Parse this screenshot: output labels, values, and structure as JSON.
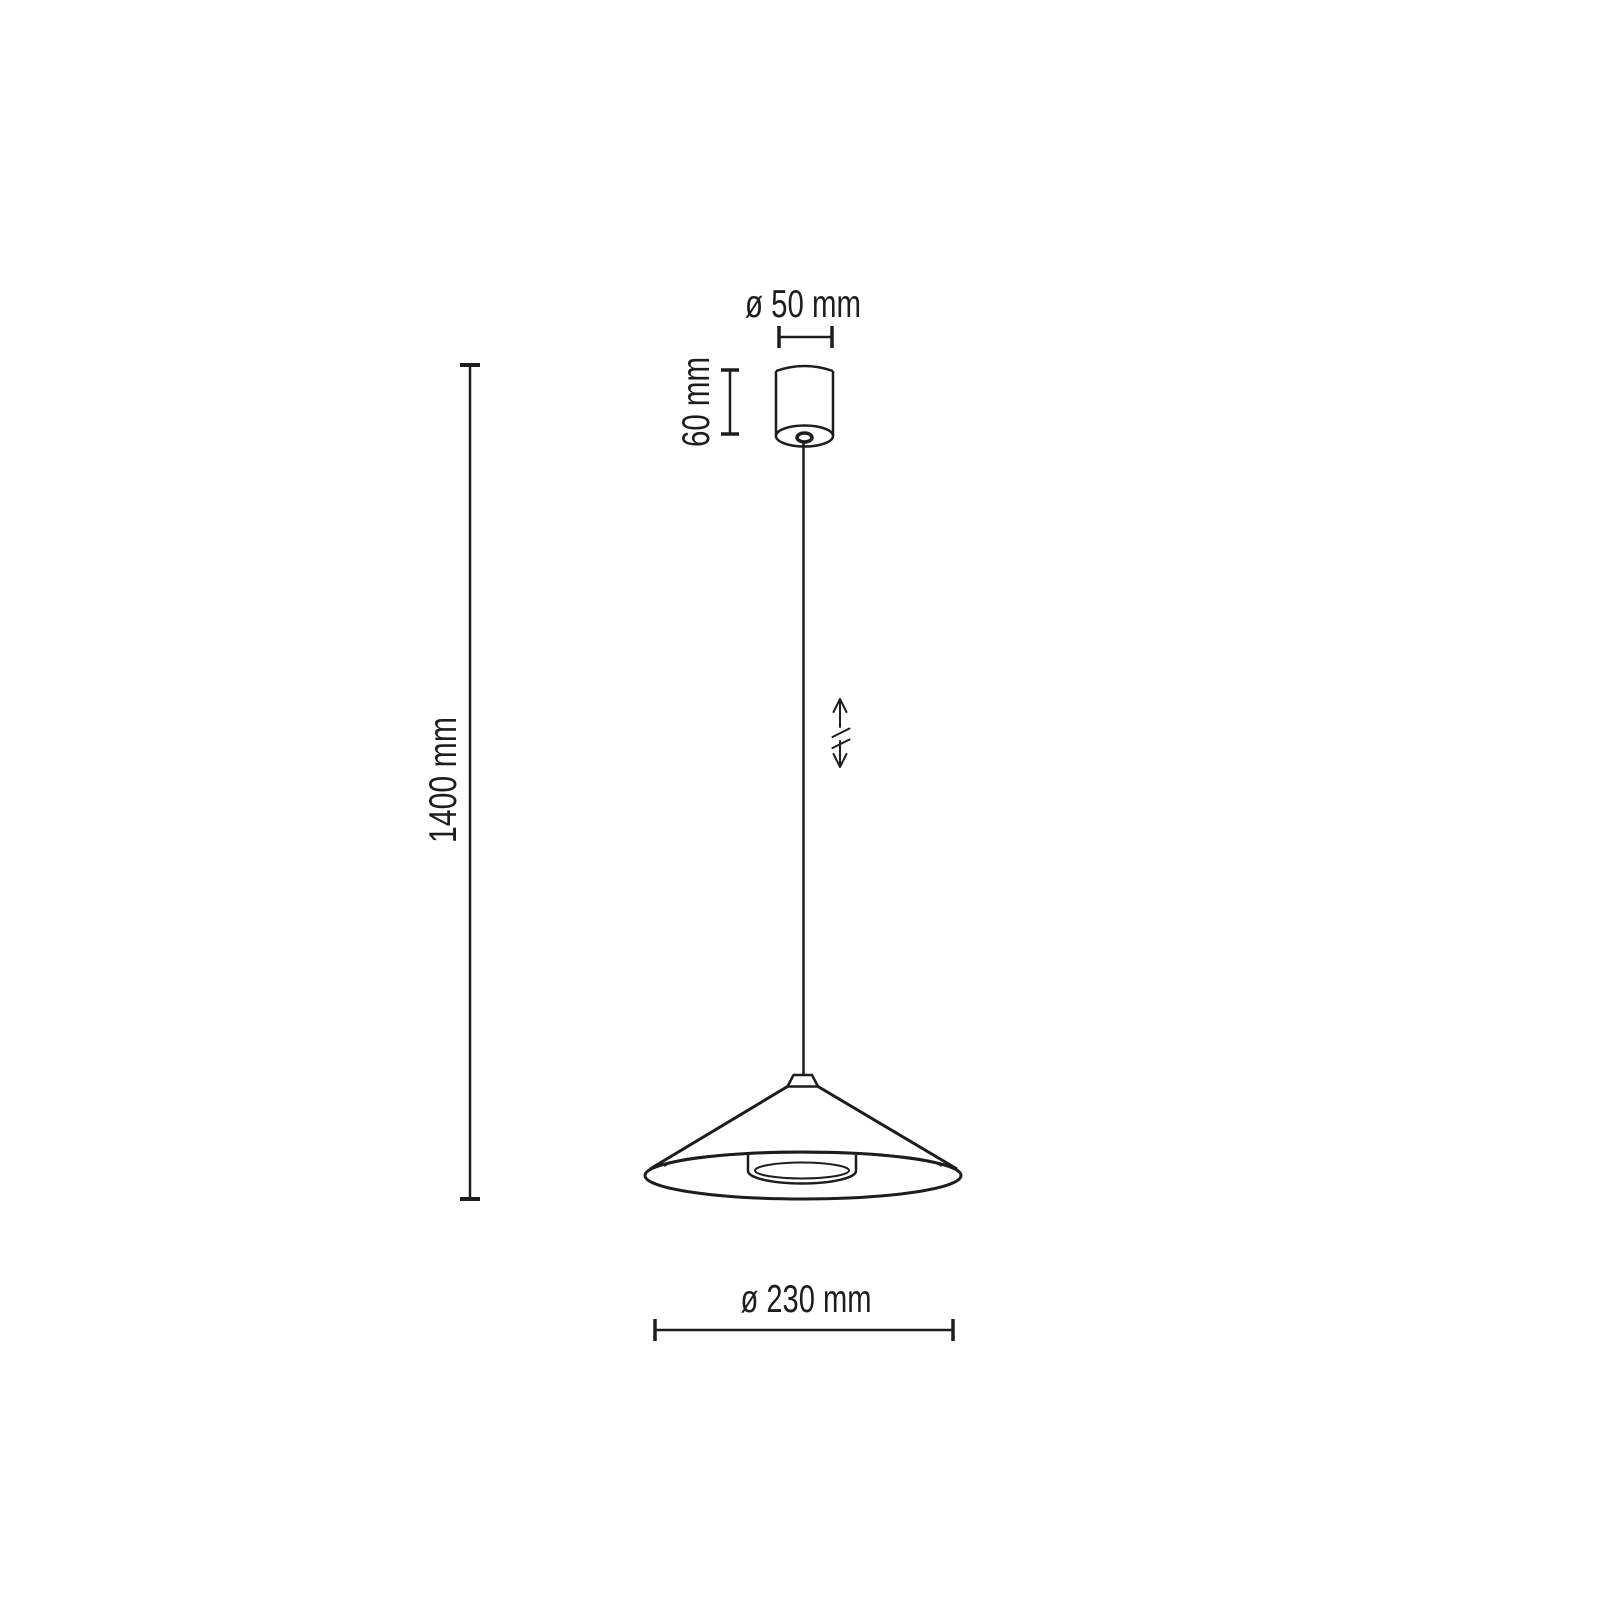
{
  "diagram": {
    "labels": {
      "canopy_diameter": "ø 50 mm",
      "canopy_height": "60 mm",
      "overall_height": "1400 mm",
      "shade_diameter": "ø 230 mm"
    },
    "colors": {
      "line": "#1d1d1b",
      "background": "#ffffff"
    }
  }
}
